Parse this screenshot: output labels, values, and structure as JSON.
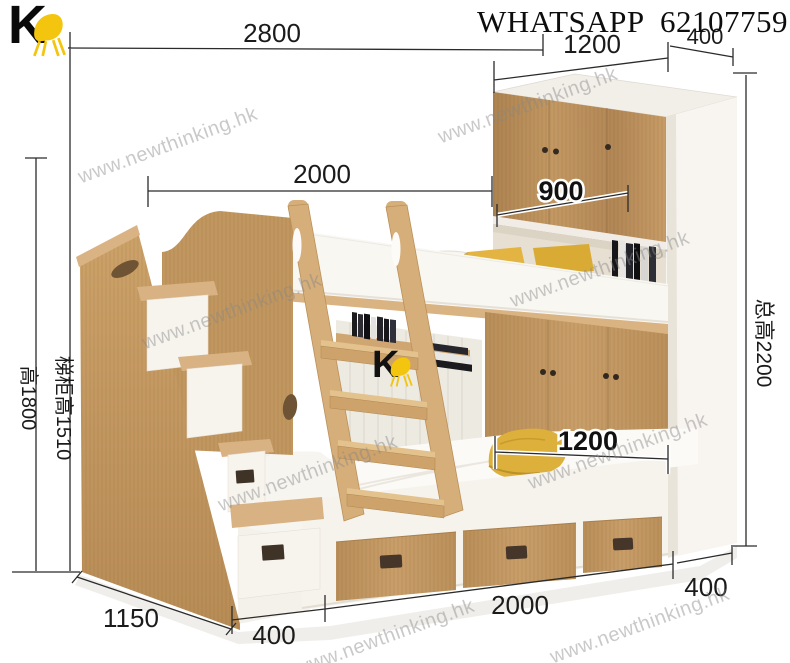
{
  "brand": {
    "logo_letter": "K"
  },
  "header": {
    "contact": "WHATSAPP  62107759"
  },
  "watermark": {
    "text": "www.newthinking.hk"
  },
  "dims": {
    "overall_width": "2800",
    "cabinet_width": "1200",
    "cabinet_depth": "400",
    "bed_length": "2000",
    "cabinet_opening": "900",
    "total_height": "总高2200",
    "left_height": "高1800",
    "stair_cabinet_height": "梯柜高1510",
    "mattress_width": "1200",
    "stair_depth": "1150",
    "stair_width": "400",
    "drawer_run": "2000",
    "wardrobe_depth": "400"
  },
  "colors": {
    "wood": "#c79e68",
    "wood_dark": "#b0854f",
    "wood_light": "#dcb888",
    "white_panel": "#f7f4ef",
    "pillow_yellow": "#ddb03b",
    "dim_line": "#2b2b2b",
    "logo_yellow": "#f3c50e",
    "watermark_gray": "#878787"
  }
}
